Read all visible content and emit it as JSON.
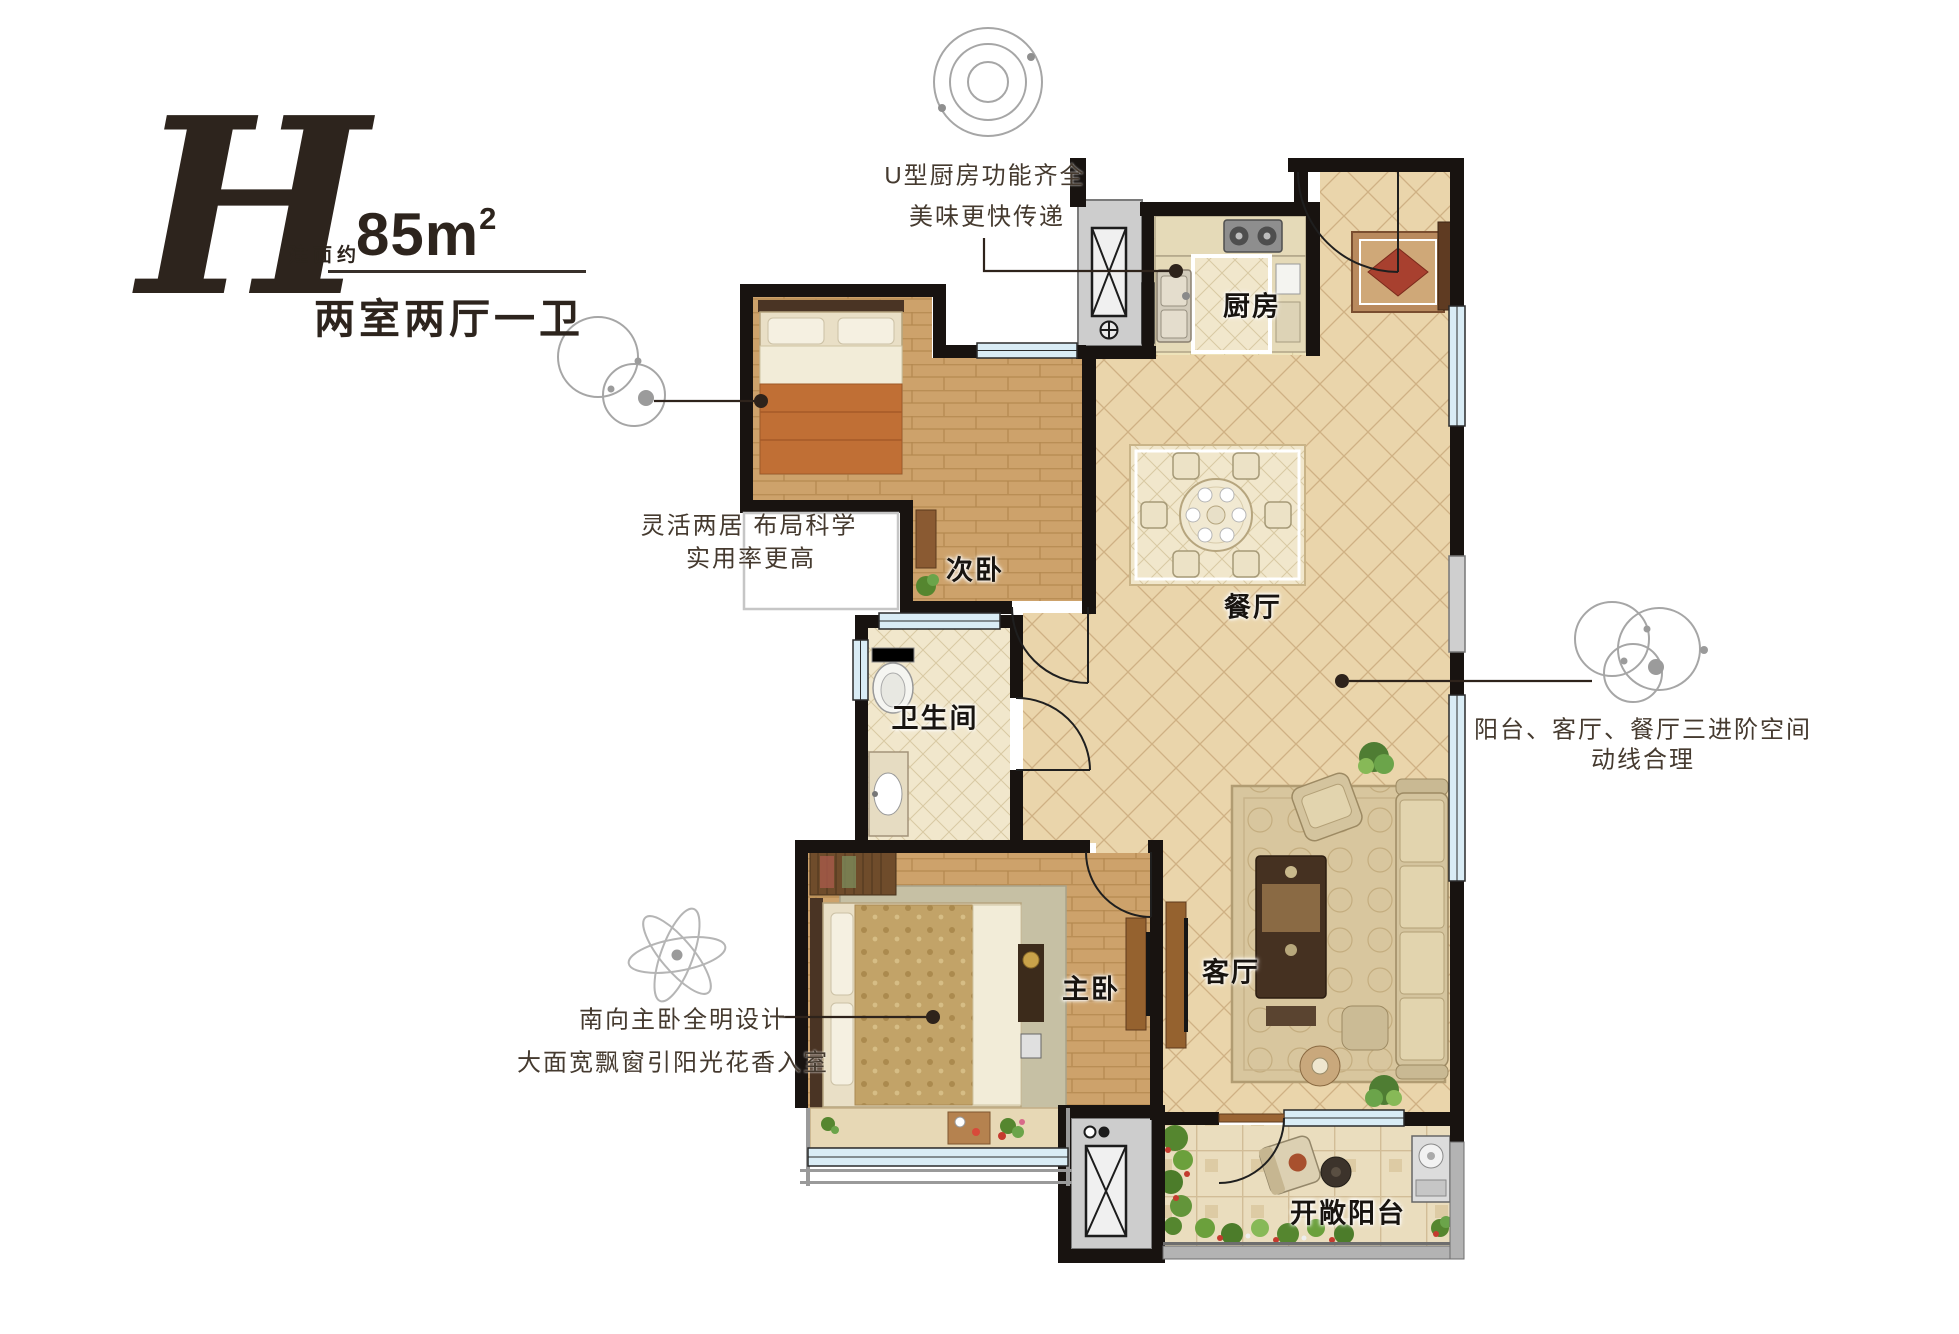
{
  "header": {
    "letter": "H",
    "area_label": "建面约",
    "area_value": "85m",
    "area_sup": "2",
    "layout_text": "两室两厅一卫"
  },
  "callouts": {
    "kitchen": {
      "line1": "U型厨房功能齐全",
      "line2": "美味更快传递"
    },
    "flexible": {
      "line1": "灵活两居 布局科学",
      "line2": "实用率更高"
    },
    "circulation": {
      "line1": "阳台、客厅、餐厅三进阶空间",
      "line2": "动线合理"
    },
    "master": {
      "line1": "南向主卧全明设计",
      "line2": "大面宽飘窗引阳光花香入室"
    }
  },
  "rooms": {
    "kitchen": "厨房",
    "second_bedroom": "次卧",
    "dining": "餐厅",
    "bathroom": "卫生间",
    "master_bedroom": "主卧",
    "living": "客厅",
    "balcony": "开敞阳台"
  },
  "colors": {
    "wall": "#181310",
    "wood_floor": "#cda26b",
    "tile_floor": "#ead5ab",
    "window_glass": "#d9ecf5",
    "leader_line": "#2e231b",
    "icon_gray": "#a6a6a6"
  }
}
